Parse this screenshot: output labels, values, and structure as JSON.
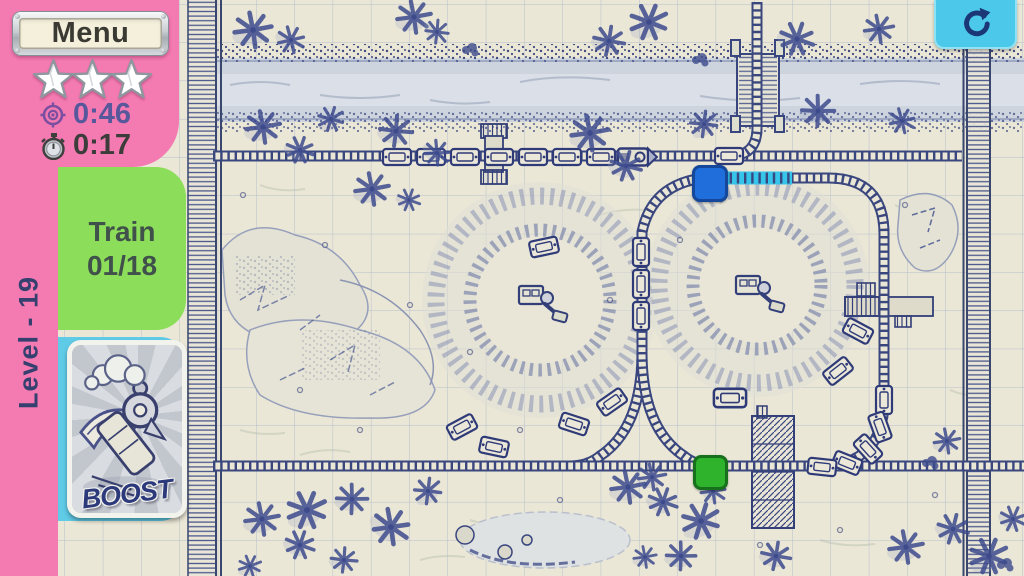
{
  "hud": {
    "menu_label": "Menu",
    "stars_total": 3,
    "stars_earned": 3,
    "target_time": "0:46",
    "elapsed_time": "0:17",
    "train_label": "Train",
    "train_progress": "01/18",
    "level_label": "Level - 19",
    "boost_label": "BOOST"
  },
  "icons": {
    "restart": "circular-arrow-icon",
    "target": "target-icon",
    "stopwatch": "stopwatch-icon",
    "star": "star-icon"
  },
  "colors": {
    "sidebar_pink": "#f47ab2",
    "train_tab_green": "#8cde5a",
    "boost_tab_cyan": "#5fcbe7",
    "paper": "#ebe7d6",
    "ink_blue": "#3a477f",
    "restart_cyan": "#4cc8ea",
    "switch_blue": "#1f6edc",
    "switch_green": "#2fb32c",
    "track_highlight": "#35c4ea",
    "target_time_text": "#57589b",
    "elapsed_time_text": "#3c3c3a"
  },
  "map": {
    "markers": [
      {
        "name": "blue-switch",
        "shape": "rounded-square",
        "color": "#1f6edc"
      },
      {
        "name": "green-switch",
        "shape": "rounded-square",
        "color": "#2fb32c"
      }
    ]
  }
}
